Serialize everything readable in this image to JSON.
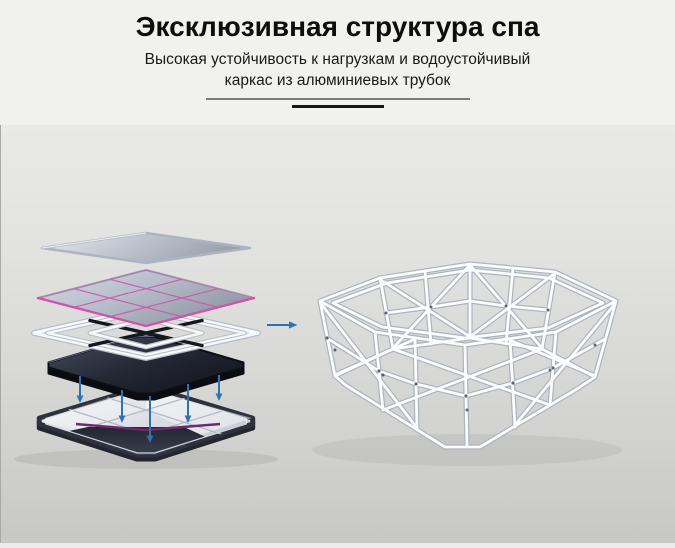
{
  "header": {
    "title": "Эксклюзивная структура спа",
    "subtitle_line1": "Высокая устойчивость к нагрузкам и водоустойчивый",
    "subtitle_line2": "каркас из алюминиевых трубок"
  },
  "icons": {
    "flow_arrow": "right-arrow",
    "assembly_arrows": "down-arrow"
  },
  "colors": {
    "accent_blue": "#2e73ad",
    "seam_pink": "#cf53a6",
    "stripe_purple": "#6f2a6e",
    "tube_white": "#fbfcfd",
    "dark_layer": "#1b1e28",
    "stage_top": "#e9e9e8",
    "stage_bottom": "#c7c7c6",
    "hero_bg": "#f1f1ef"
  }
}
